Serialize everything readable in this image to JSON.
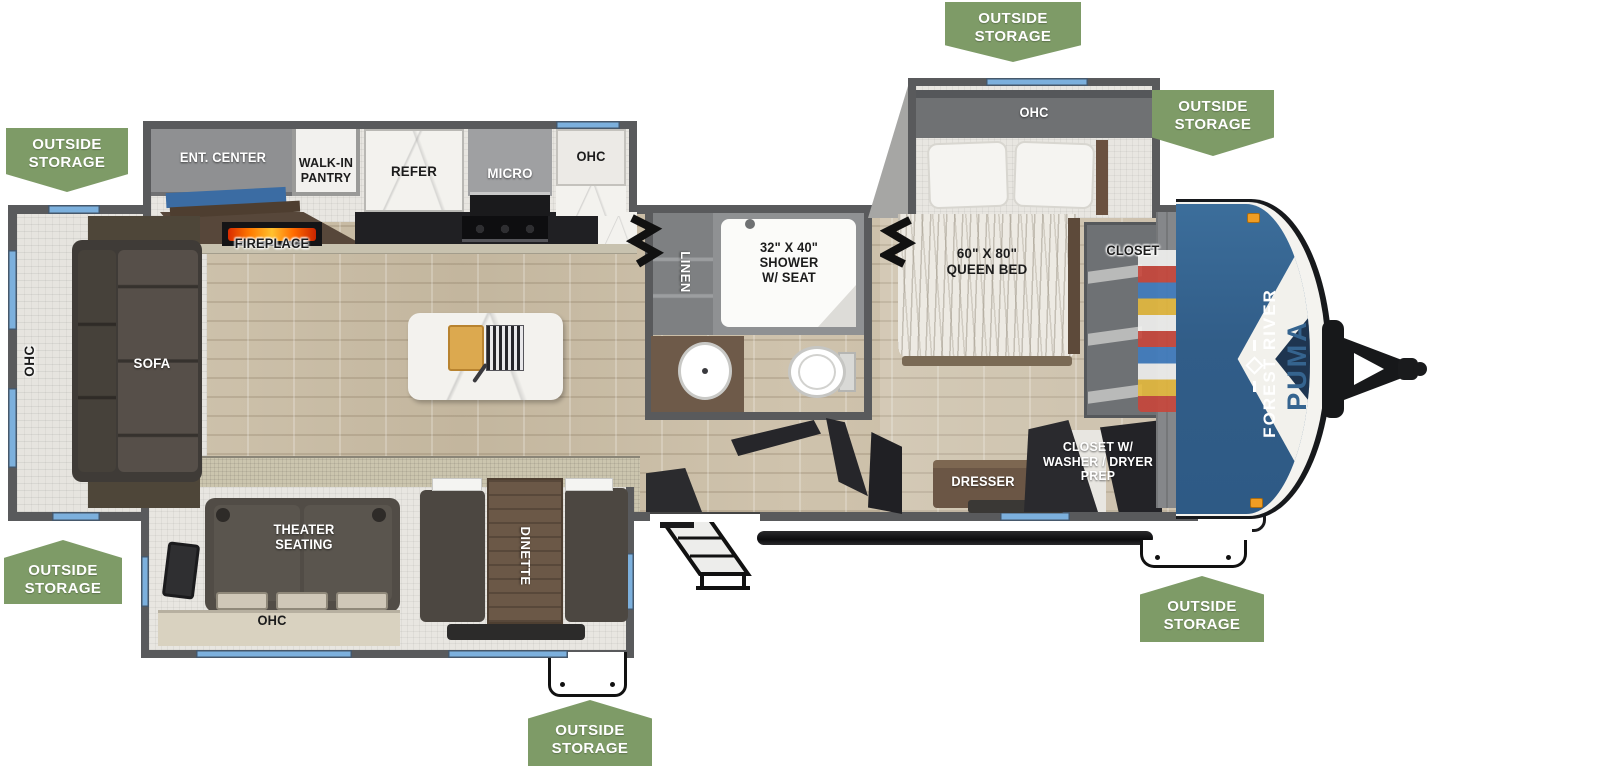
{
  "colors": {
    "banner_green": "#7e9b67",
    "wall": "#595a5c",
    "window_blue": "#7cb0dd",
    "cap_blue": "#35648f",
    "cap_navy": "#1e3550",
    "accent_orange": "#f09d23",
    "floor": "#cbbfa8",
    "slide_floor": "#e8e6e1",
    "furn_dark": "#4d4843",
    "wood_brown": "#6b5847"
  },
  "outside_storage": {
    "line1": "OUTSIDE",
    "line2": "STORAGE"
  },
  "brand": {
    "forest_river": "FOREST RIVER",
    "puma": "PUMA"
  },
  "rooms": {
    "kitchen": {
      "ent_center": "ENT. CENTER",
      "pantry_l1": "WALK-IN",
      "pantry_l2": "PANTRY",
      "refer": "REFER",
      "micro": "MICRO",
      "ohc": "OHC",
      "fireplace": "FIREPLACE"
    },
    "living": {
      "sofa": "SOFA",
      "ohc": "OHC"
    },
    "bath": {
      "linen": "LINEN",
      "shower_l1": "32\" X 40\"",
      "shower_l2": "SHOWER",
      "shower_l3": "W/ SEAT"
    },
    "bedroom": {
      "ohc": "OHC",
      "bed_l1": "60\" X 80\"",
      "bed_l2": "QUEEN BED",
      "closet": "CLOSET",
      "dresser": "DRESSER",
      "wd_l1": "CLOSET W/",
      "wd_l2": "WASHER / DRYER",
      "wd_l3": "PREP"
    },
    "bottom_slide": {
      "theater_l1": "THEATER",
      "theater_l2": "SEATING",
      "dinette": "DINETTE",
      "ohc": "OHC"
    }
  }
}
